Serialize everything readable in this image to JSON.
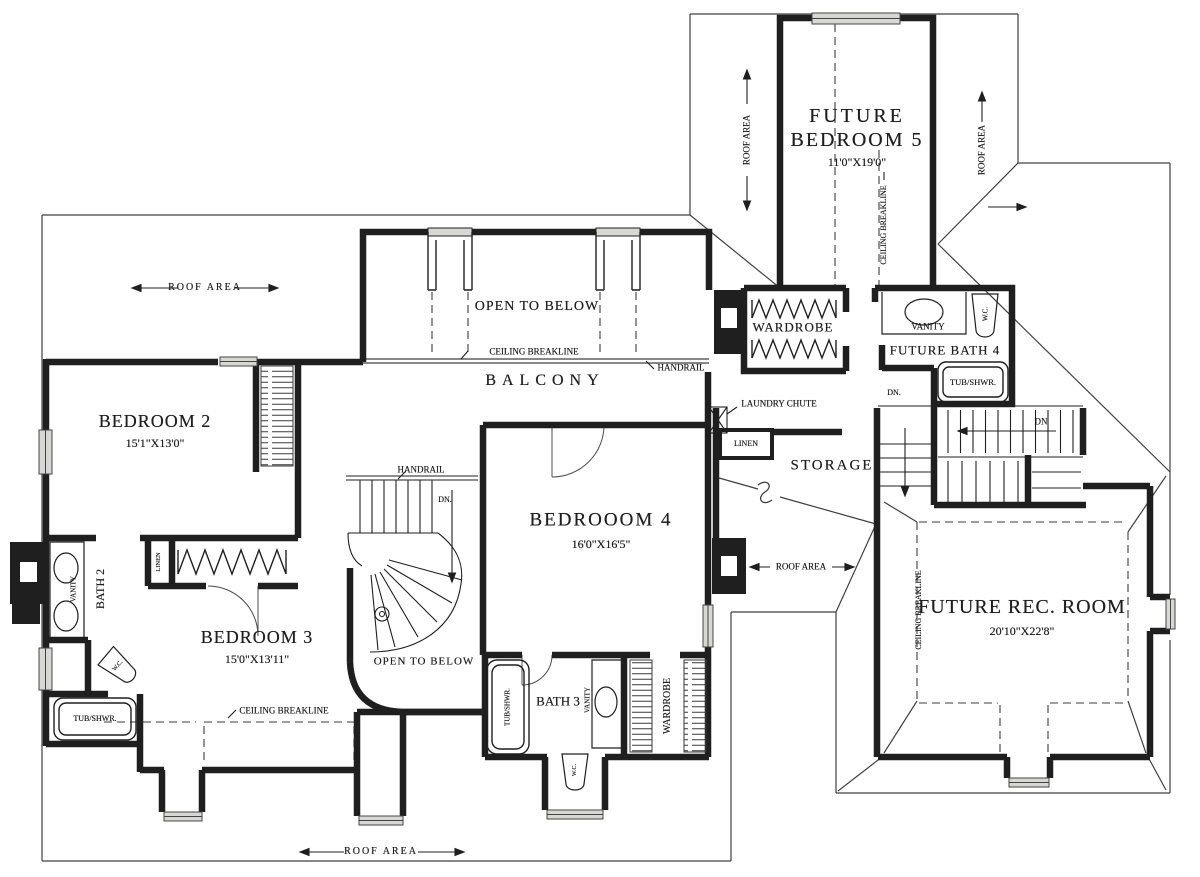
{
  "colors": {
    "ink": "#1f1f1f",
    "paper": "#ffffff",
    "window_fill": "#d8d8d2"
  },
  "rooms": {
    "future_bedroom_5": {
      "line1": "FUTURE",
      "line2": "BEDROOM 5",
      "dims": "11'0\"X19'0\""
    },
    "bedroom_2": {
      "name": "BEDROOM 2",
      "dims": "15'1\"X13'0\""
    },
    "bedroom_3": {
      "name": "BEDROOM 3",
      "dims": "15'0\"X13'11\""
    },
    "bedroom_4": {
      "name": "BEDROOOM 4",
      "dims": "16'0\"X16'5\""
    },
    "future_rec_room": {
      "name": "FUTURE REC. ROOM",
      "dims": "20'10\"X22'8\""
    },
    "future_bath_4": {
      "name": "FUTURE BATH 4"
    },
    "bath_2": {
      "name": "BATH 2"
    },
    "bath_3": {
      "name": "BATH 3"
    },
    "balcony": {
      "name": "BALCONY"
    },
    "storage": {
      "name": "STORAGE"
    },
    "wardrobe": {
      "name": "WARDROBE"
    },
    "linen": {
      "name": "LINEN"
    }
  },
  "annotations": {
    "roof_area": "ROOF AREA",
    "ceiling_breakline": "CEILING BREAKLINE",
    "open_to_below": "OPEN TO BELOW",
    "handrail": "HANDRAIL",
    "laundry_chute": "LAUNDRY CHUTE",
    "down": "DN",
    "down_abbr": "DN.",
    "vanity": "VANITY",
    "water_closet": "W.C.",
    "tub_shower": "TUB/SHWR."
  }
}
